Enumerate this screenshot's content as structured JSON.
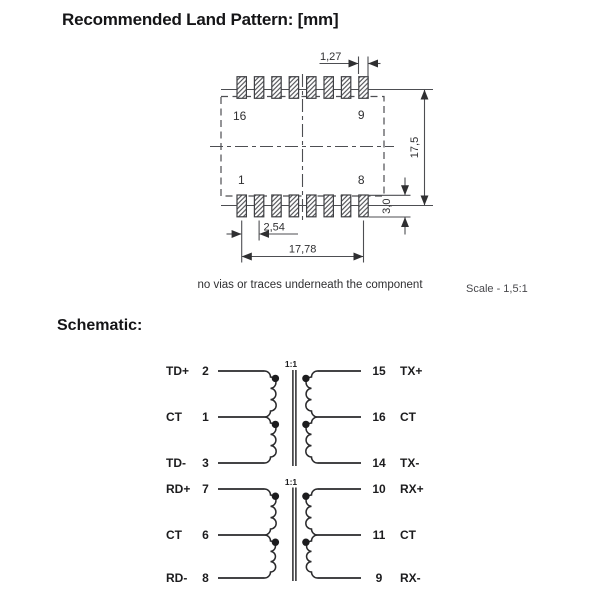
{
  "title": "Recommended Land Pattern: [mm]",
  "note": "no vias or traces underneath the component",
  "scale_label": "Scale - 1,5:1",
  "schematic_heading": "Schematic:",
  "land": {
    "corner_tl": "16",
    "corner_tr": "9",
    "corner_bl": "1",
    "corner_br": "8",
    "dim_pad_width": "1,27",
    "dim_overall_height": "17,5",
    "dim_pad_height": "3,0",
    "dim_pitch": "2,54",
    "dim_row_span": "17,78"
  },
  "schematic": {
    "t1": {
      "ratio": "1:1",
      "left": [
        {
          "name": "TD+",
          "pin": "2"
        },
        {
          "name": "CT",
          "pin": "1"
        },
        {
          "name": "TD-",
          "pin": "3"
        }
      ],
      "right": [
        {
          "pin": "15",
          "name": "TX+"
        },
        {
          "pin": "16",
          "name": "CT"
        },
        {
          "pin": "14",
          "name": "TX-"
        }
      ]
    },
    "t2": {
      "ratio": "1:1",
      "left": [
        {
          "name": "RD+",
          "pin": "7"
        },
        {
          "name": "CT",
          "pin": "6"
        },
        {
          "name": "RD-",
          "pin": "8"
        }
      ],
      "right": [
        {
          "pin": "10",
          "name": "RX+"
        },
        {
          "pin": "11",
          "name": "CT"
        },
        {
          "pin": "9",
          "name": "RX-"
        }
      ]
    }
  },
  "colors": {
    "land_line": "#4d4e52",
    "schematic_line": "#2a2a2c",
    "text": "#1c1c1e"
  }
}
